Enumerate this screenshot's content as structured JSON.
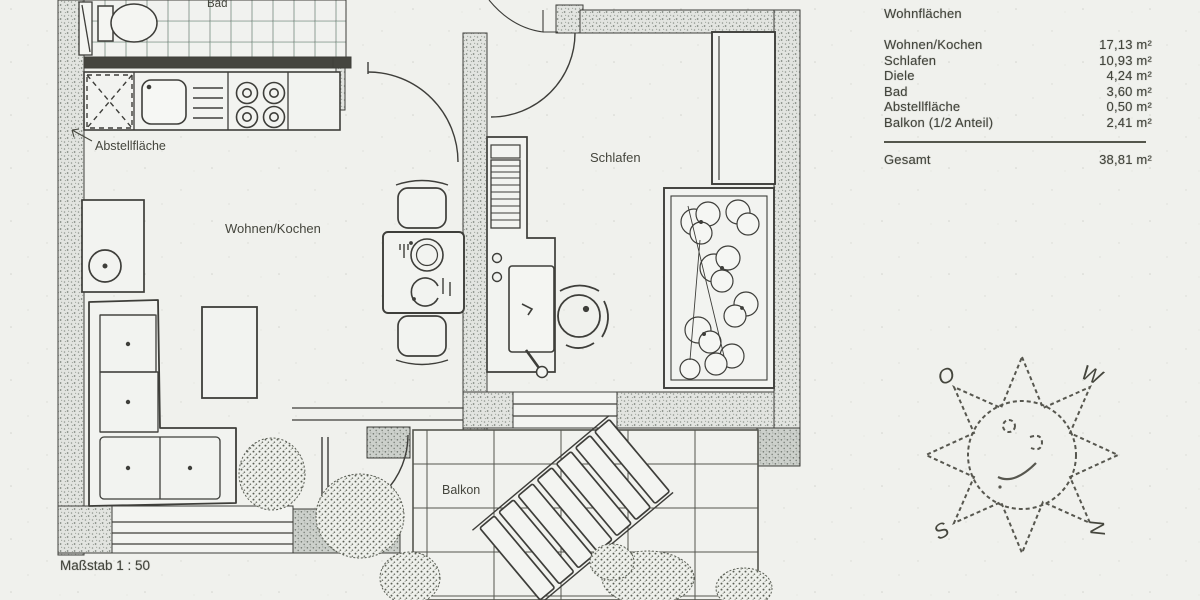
{
  "page": {
    "scale_label": "Maßstab 1 : 50"
  },
  "floor_plan": {
    "room_labels": {
      "bad": "Bad",
      "abstellflaeche": "Abstellfläche",
      "wohnen_kochen": "Wohnen/Kochen",
      "schlafen": "Schlafen",
      "balkon": "Balkon"
    }
  },
  "area_table": {
    "title": "Wohnflächen",
    "rows": [
      {
        "label": "Wohnen/Kochen",
        "value": "17,13 m²"
      },
      {
        "label": "Schlafen",
        "value": "10,93 m²"
      },
      {
        "label": "Diele",
        "value": "4,24 m²"
      },
      {
        "label": "Bad",
        "value": "3,60 m²"
      },
      {
        "label": "Abstellfläche",
        "value": "0,50 m²"
      },
      {
        "label": "Balkon (1/2 Anteil)",
        "value": "2,41 m²"
      }
    ],
    "total": {
      "label": "Gesamt",
      "value": "38,81 m²"
    }
  },
  "compass_sun": {
    "letters": {
      "top_left": "O",
      "top_right": "W",
      "bottom_left": "S",
      "bottom_right": "N"
    }
  },
  "colors": {
    "paper": "#f0f1ed",
    "line": "#3e3e3a",
    "wall_speckle": "#e3e5e1",
    "ink": "#42443b"
  }
}
